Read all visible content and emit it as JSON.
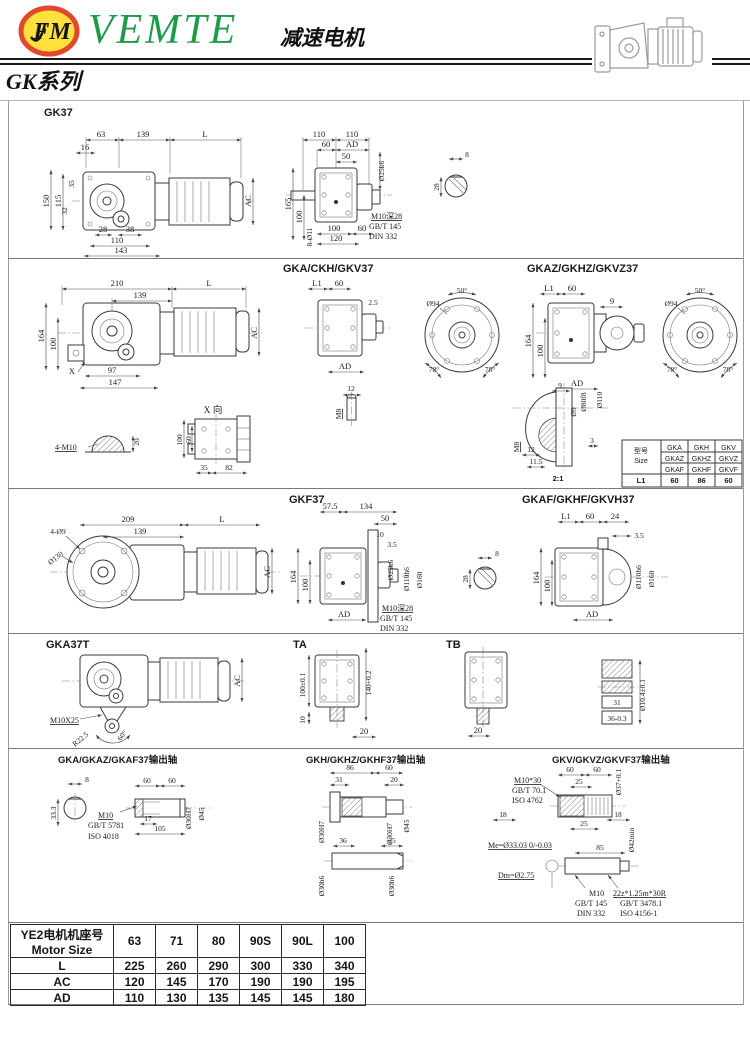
{
  "header": {
    "logo_text": "FM",
    "brand": "VEMTE",
    "doc_title": "减速电机",
    "series": "GK系列"
  },
  "s1": {
    "title": "GK37",
    "f": [
      "63",
      "139",
      "L",
      "16",
      "150",
      "115",
      "35",
      "32",
      "28",
      "38",
      "110",
      "143",
      "AC"
    ],
    "v": [
      "110",
      "110",
      "60",
      "AD",
      "50",
      "Ø25k6",
      "165",
      "100",
      "8-Ø11",
      "100",
      "60",
      "120"
    ],
    "n": [
      "M10深28",
      "GB/T 145",
      "DIN 332"
    ],
    "k": [
      "8",
      "28"
    ]
  },
  "s2": {
    "t1": "GKA/CKH/GKV37",
    "t2": "GKAZ/GKHZ/GKVZ37",
    "f": [
      "210",
      "139",
      "L",
      "164",
      "100",
      "97",
      "147",
      "X",
      "AC"
    ],
    "m10": [
      "4-M10",
      "20"
    ],
    "xv": [
      "X 向",
      "100",
      "60",
      "35",
      "82"
    ],
    "sv": [
      "L1",
      "60",
      "2.5",
      "AD",
      "12",
      "M8"
    ],
    "fl1": [
      "Ø94",
      "50°",
      "78°",
      "78°"
    ],
    "mv": [
      "L1",
      "60",
      "9",
      "164",
      "100",
      "AD"
    ],
    "fl2": [
      "Ø94",
      "50°",
      "78°",
      "78°"
    ],
    "det": [
      "9",
      "Ø80f8",
      "Ø110",
      "Ø9",
      "3",
      "M8",
      "12",
      "11.5",
      "2:1"
    ],
    "tbl": {
      "type_cn": "型号",
      "type_en": "Size",
      "rows": [
        [
          "GKA",
          "GKH",
          "GKV"
        ],
        [
          "GKAZ",
          "GKHZ",
          "GKVZ"
        ],
        [
          "GKAF",
          "GKHF",
          "GKVF"
        ]
      ],
      "l1": "L1",
      "l1v": [
        "60",
        "86",
        "60"
      ]
    }
  },
  "s3": {
    "t1": "GKF37",
    "t2": "GKAF/GKHF/GKVH37",
    "f": [
      "209",
      "139",
      "L",
      "4-Ø9",
      "Ø130",
      "AC"
    ],
    "sv": [
      "57.5",
      "134",
      "50",
      "10",
      "3.5",
      "164",
      "100",
      "AD",
      "Ø25k6",
      "Ø110h6",
      "Ø160"
    ],
    "n": [
      "M10深28",
      "GB/T 145",
      "DIN 332"
    ],
    "k": [
      "8",
      "28"
    ],
    "rv": [
      "L1",
      "60",
      "24",
      "3.5",
      "164",
      "100",
      "AD",
      "Ø110h6",
      "Ø160"
    ]
  },
  "s4": {
    "t1": "GKA37T",
    "t2": "TA",
    "t3": "TB",
    "f": [
      "M10X25",
      "R22.5",
      "60°",
      "AC"
    ],
    "ta": [
      "100±0.1",
      "140+0.2",
      "10",
      "20"
    ],
    "tb": [
      "20"
    ],
    "key": [
      "31",
      "36-0.3",
      "Ø10.4±0.1"
    ]
  },
  "s5": {
    "t1": "GKA/GKAZ/GKAF37输出轴",
    "t2": "GKH/GKHZ/GKHF37输出轴",
    "t3": "GKV/GKVZ/GKVF37输出轴",
    "a": [
      "8",
      "33.3",
      "60",
      "60",
      "17",
      "105",
      "Ø30H7",
      "Ø45"
    ],
    "an": [
      "M10",
      "GB/T 5781",
      "ISO 4018"
    ],
    "b": [
      "86",
      "60",
      "31",
      "20",
      "Ø30H7",
      "Ø30H7",
      "Ø45",
      "36",
      "25",
      "Ø30h6",
      "Ø30h6"
    ],
    "c": [
      "60",
      "60",
      "25",
      "Ø37+0.1",
      "18",
      "18",
      "25",
      "Ø42min",
      "85"
    ],
    "cn1": [
      "M10*30",
      "GB/T 70.1",
      "ISO 4762"
    ],
    "cn2": [
      "Me=Ø33.03 0/-0.03",
      "Dm=Ø2.75"
    ],
    "cn3": [
      "M10",
      "GB/T 145",
      "DIN 332"
    ],
    "cn4": [
      "22z*1.25m*30R",
      "GB/T 3478.1",
      "ISO 4156-1"
    ]
  },
  "motor_table": {
    "header_cn": "YE2电机机座号",
    "header_en": "Motor Size",
    "sizes": [
      "63",
      "71",
      "80",
      "90S",
      "90L",
      "100"
    ],
    "rows": [
      {
        "label": "L",
        "values": [
          "225",
          "260",
          "290",
          "300",
          "330",
          "340"
        ]
      },
      {
        "label": "AC",
        "values": [
          "120",
          "145",
          "170",
          "190",
          "190",
          "195"
        ]
      },
      {
        "label": "AD",
        "values": [
          "110",
          "130",
          "135",
          "145",
          "145",
          "180"
        ]
      }
    ]
  }
}
